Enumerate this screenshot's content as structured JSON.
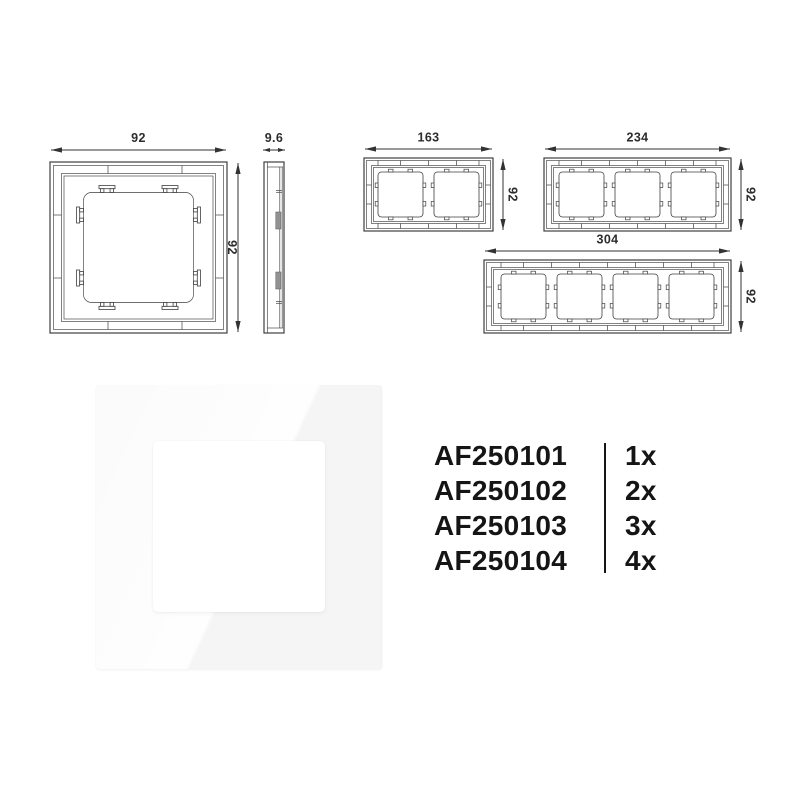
{
  "drawings": {
    "single_front": {
      "width_label": "92",
      "height_label": "92"
    },
    "side_profile": {
      "depth_label": "9.6"
    },
    "frame_2gang": {
      "width_label": "163",
      "height_label": "92"
    },
    "frame_3gang": {
      "width_label": "234",
      "height_label": "92"
    },
    "frame_4gang": {
      "width_label": "304",
      "height_label": "92"
    }
  },
  "product_list": {
    "rows": [
      {
        "sku": "AF250101",
        "qty": "1x"
      },
      {
        "sku": "AF250102",
        "qty": "2x"
      },
      {
        "sku": "AF250103",
        "qty": "3x"
      },
      {
        "sku": "AF250104",
        "qty": "4x"
      }
    ]
  },
  "colors": {
    "background": "#ffffff",
    "drawing_line": "#3f3f3f",
    "dimension_text": "#2d2d2d",
    "list_text": "#151515"
  }
}
